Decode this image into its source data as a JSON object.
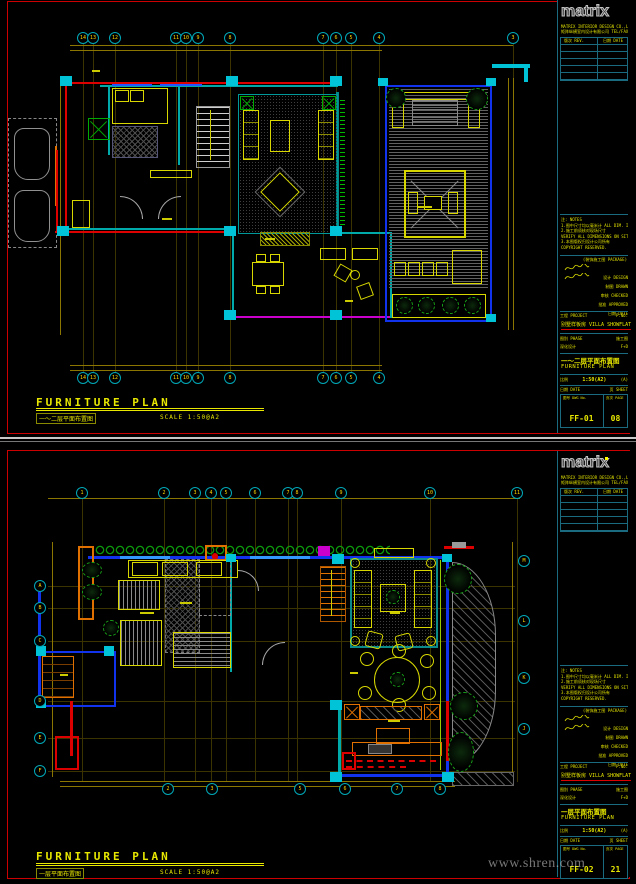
{
  "watermark": "www.shren.com",
  "sheets": [
    {
      "footer": {
        "title": "FURNITURE PLAN",
        "subtitle_cn": "一～二层平面布置图",
        "scale": "SCALE  1:50@A2"
      },
      "bubbles": [
        [
          83,
          38,
          "14"
        ],
        [
          93,
          38,
          "13"
        ],
        [
          115,
          38,
          "12"
        ],
        [
          176,
          38,
          "11"
        ],
        [
          186,
          38,
          "10"
        ],
        [
          198,
          38,
          "9"
        ],
        [
          230,
          38,
          "8"
        ],
        [
          323,
          38,
          "7"
        ],
        [
          336,
          38,
          "6"
        ],
        [
          351,
          38,
          "5"
        ],
        [
          379,
          38,
          "4"
        ],
        [
          513,
          38,
          "3"
        ],
        [
          83,
          378,
          "14"
        ],
        [
          93,
          378,
          "13"
        ],
        [
          115,
          378,
          "12"
        ],
        [
          176,
          378,
          "11"
        ],
        [
          186,
          378,
          "10"
        ],
        [
          198,
          378,
          "9"
        ],
        [
          230,
          378,
          "8"
        ],
        [
          323,
          378,
          "7"
        ],
        [
          336,
          378,
          "6"
        ],
        [
          351,
          378,
          "5"
        ],
        [
          379,
          378,
          "4"
        ]
      ],
      "grid": {
        "v": [
          [
            83,
            44,
            372
          ],
          [
            93,
            44,
            372
          ],
          [
            115,
            44,
            372
          ],
          [
            176,
            44,
            372
          ],
          [
            186,
            44,
            372
          ],
          [
            198,
            44,
            372
          ],
          [
            230,
            44,
            372
          ],
          [
            323,
            44,
            372
          ],
          [
            336,
            44,
            372
          ],
          [
            351,
            44,
            372
          ],
          [
            379,
            44,
            372
          ],
          [
            513,
            44,
            80
          ]
        ],
        "h": []
      },
      "titleblock": {
        "logo": "matrix",
        "company_lines": [
          "MATRIX INTERIOR DESIGN CO.,LTD.",
          "矩阵纵横室内设计有限公司 TEL/FAX"
        ],
        "rev_headers": [
          "版次 REV.",
          "日期 DATE"
        ],
        "notes_lines": [
          "注: NOTES",
          "1.图中尺寸均以毫米计 ALL DIM. IN MM.",
          "2.施工前须核对现场尺寸",
          "  VERIFY ALL DIMENSIONS ON SITE.",
          "3.本图版权归设计公司所有",
          "  COPYRIGHT RESERVED."
        ],
        "pkg_note": "(装饰施工图 PACKAGE)",
        "sig_rows": [
          {
            "label": "设计 DESIGN",
            "sig": true
          },
          {
            "label": "制图 DRAWN",
            "sig": true
          },
          {
            "label": "审核 CHECKED",
            "sig": false
          },
          {
            "label": "批准 APPROVED",
            "sig": false
          },
          {
            "label": "日期 DATE",
            "sig": false
          }
        ],
        "project_label": "工程 PROJECT",
        "project_no_label": "P.NO.",
        "project_name": "别墅样板房 VILLA SHOWFLAT",
        "phase_label": "图别 PHASE",
        "phase_right": "施工图",
        "stage_value": "深化设计",
        "stage_right": "F+D",
        "title_cn": "一～二层平面布置图",
        "title_en": "FURNITURE PLAN",
        "scale_label": "比例",
        "scale_value": "1:50(A2)",
        "scale_suffix": "(A)",
        "date_label": "日期 DATE",
        "sheet_label": "页 SHEET",
        "dwg_label": "图号 DWG No.",
        "dwg_no": "FF-01",
        "page_label": "页次 PAGE",
        "page_no": "08"
      }
    },
    {
      "footer": {
        "title": "FURNITURE PLAN",
        "subtitle_cn": "一层平面布置图",
        "scale": "SCALE  1:50@A2"
      },
      "bubbles": [
        [
          82,
          51,
          "1"
        ],
        [
          164,
          51,
          "2"
        ],
        [
          195,
          51,
          "3"
        ],
        [
          211,
          51,
          "4"
        ],
        [
          226,
          51,
          "5"
        ],
        [
          255,
          51,
          "6"
        ],
        [
          288,
          51,
          "7"
        ],
        [
          297,
          51,
          "8"
        ],
        [
          341,
          51,
          "9"
        ],
        [
          430,
          51,
          "10"
        ],
        [
          517,
          51,
          "11"
        ],
        [
          40,
          144,
          "A"
        ],
        [
          40,
          166,
          "B"
        ],
        [
          40,
          199,
          "C"
        ],
        [
          40,
          259,
          "D"
        ],
        [
          40,
          296,
          "E"
        ],
        [
          40,
          329,
          "F"
        ],
        [
          524,
          119,
          "M"
        ],
        [
          524,
          179,
          "L"
        ],
        [
          524,
          236,
          "K"
        ],
        [
          524,
          287,
          "J"
        ],
        [
          168,
          347,
          "2"
        ],
        [
          212,
          347,
          "3"
        ],
        [
          300,
          347,
          "5"
        ],
        [
          345,
          347,
          "6"
        ],
        [
          397,
          347,
          "7"
        ],
        [
          440,
          347,
          "8"
        ]
      ],
      "grid": {
        "v": [
          [
            82,
            56,
            340
          ],
          [
            164,
            56,
            340
          ],
          [
            195,
            56,
            340
          ],
          [
            211,
            56,
            340
          ],
          [
            226,
            56,
            340
          ],
          [
            255,
            56,
            340
          ],
          [
            288,
            56,
            340
          ],
          [
            297,
            56,
            340
          ],
          [
            341,
            56,
            340
          ],
          [
            430,
            56,
            340
          ],
          [
            517,
            56,
            340
          ]
        ],
        "h": [
          [
            144,
            48,
            515
          ],
          [
            166,
            48,
            515
          ],
          [
            199,
            48,
            515
          ],
          [
            259,
            48,
            515
          ],
          [
            296,
            48,
            515
          ],
          [
            329,
            48,
            515
          ]
        ]
      },
      "titleblock": {
        "logo": "matrix",
        "company_lines": [
          "MATRIX INTERIOR DESIGN CO.,LTD.",
          "矩阵纵横室内设计有限公司 TEL/FAX"
        ],
        "rev_headers": [
          "版次 REV.",
          "日期 DATE"
        ],
        "notes_lines": [
          "注: NOTES",
          "1.图中尺寸均以毫米计 ALL DIM. IN MM.",
          "2.施工前须核对现场尺寸",
          "  VERIFY ALL DIMENSIONS ON SITE.",
          "3.本图版权归设计公司所有",
          "  COPYRIGHT RESERVED."
        ],
        "pkg_note": "(装饰施工图 PACKAGE)",
        "sig_rows": [
          {
            "label": "设计 DESIGN",
            "sig": true
          },
          {
            "label": "制图 DRAWN",
            "sig": true
          },
          {
            "label": "审核 CHECKED",
            "sig": false
          },
          {
            "label": "批准 APPROVED",
            "sig": false
          },
          {
            "label": "日期 DATE",
            "sig": false
          }
        ],
        "project_label": "工程 PROJECT",
        "project_no_label": "P.NO.",
        "project_name": "别墅样板房 VILLA SHOWFLAT",
        "phase_label": "图别 PHASE",
        "phase_right": "施工图",
        "stage_value": "深化设计",
        "stage_right": "F+D",
        "title_cn": "一层平面布置图",
        "title_en": "FURNITURE PLAN",
        "scale_label": "比例",
        "scale_value": "1:50(A2)",
        "scale_suffix": "(A)",
        "date_label": "日期 DATE",
        "sheet_label": "页 SHEET",
        "dwg_label": "图号 DWG No.",
        "dwg_no": "FF-02",
        "page_label": "页次 PAGE",
        "page_no": "21"
      }
    }
  ]
}
